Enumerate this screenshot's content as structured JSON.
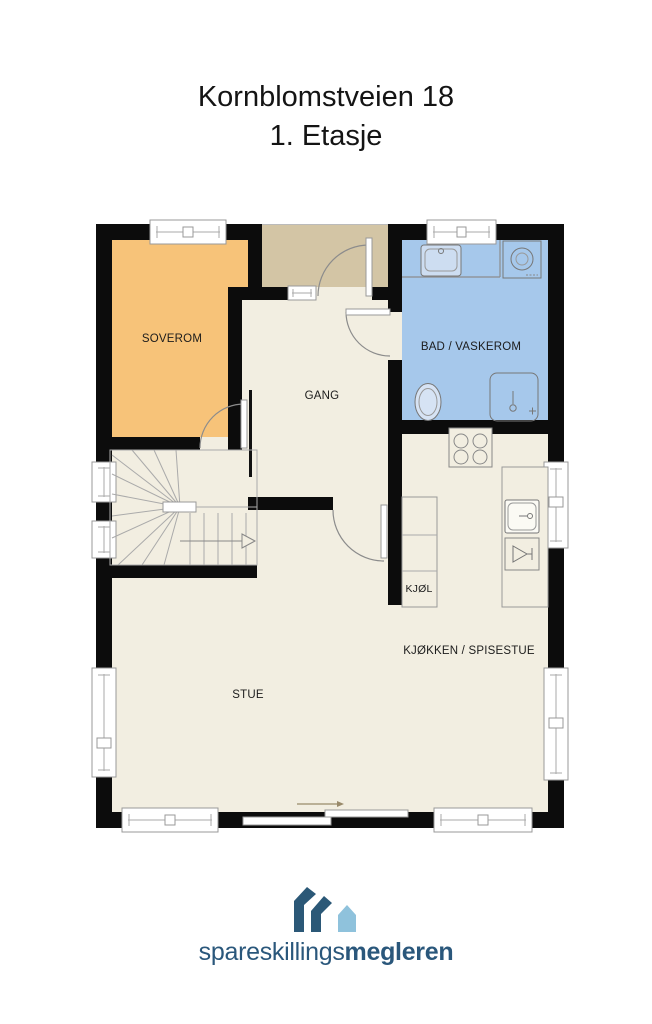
{
  "title": {
    "line1": "Kornblomstveien 18",
    "line2": "1. Etasje"
  },
  "rooms": {
    "soverom": {
      "label": "SOVEROM",
      "color": "#f7c379"
    },
    "gang": {
      "label": "GANG"
    },
    "bad": {
      "label": "BAD / VASKEROM",
      "color": "#a6c8eb"
    },
    "kjol": {
      "label": "KJØL"
    },
    "kjokken": {
      "label": "KJØKKEN / SPISESTUE"
    },
    "stue": {
      "label": "STUE"
    },
    "entre": {
      "color": "#d3c5a5"
    }
  },
  "plan": {
    "floor_color": "#f2eee1",
    "wall_color": "#0c0c0c"
  },
  "logo": {
    "text_regular": "spareskillings",
    "text_bold": "megleren",
    "text_color": "#2a577b",
    "icon_dark": "#2b5877",
    "icon_light": "#8fc2dc"
  }
}
